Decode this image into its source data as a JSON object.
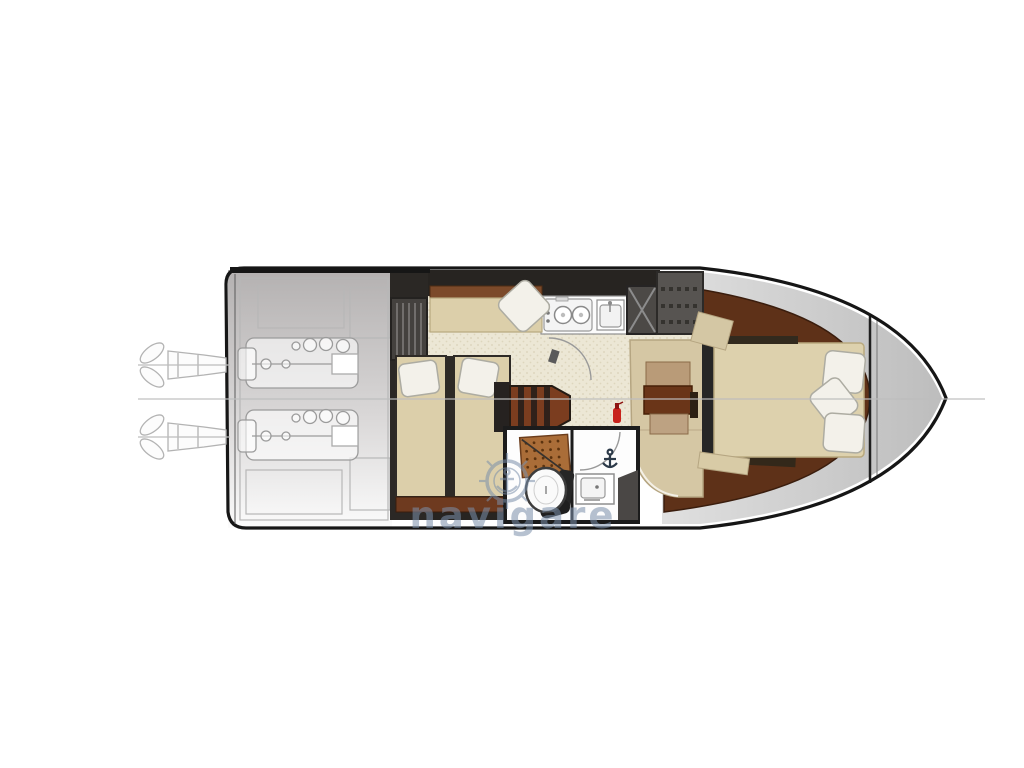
{
  "watermark": {
    "text": "navigare",
    "color": "#7b90ab",
    "logo": "ships-wheel-anchor-icon",
    "opacity": 0.55
  },
  "palette": {
    "background": "#ffffff",
    "hull_outline": "#161616",
    "engine_room_gray": "#b6b3b3",
    "line_art_gray": "#9b9b9b",
    "wall_dark": "#272421",
    "floor_speckle_base": "#ece7d5",
    "floor_speckle_dot": "#d9d2b8",
    "berth_tan": "#dccfaa",
    "berth_trim_brown": "#7c4a2a",
    "wood_floor_brown": "#5e3118",
    "stairs_brown": "#7b3d1f",
    "cabinet_dark": "#4f4c49",
    "pillow_white": "#f3f1ea",
    "teak_grate": "#aa6d38",
    "table_brown": "#6a3518",
    "fire_extinguisher_red": "#c8231c",
    "bow_deck_gray": "#cccccc",
    "centerline_gray": "#bdbdbd"
  }
}
